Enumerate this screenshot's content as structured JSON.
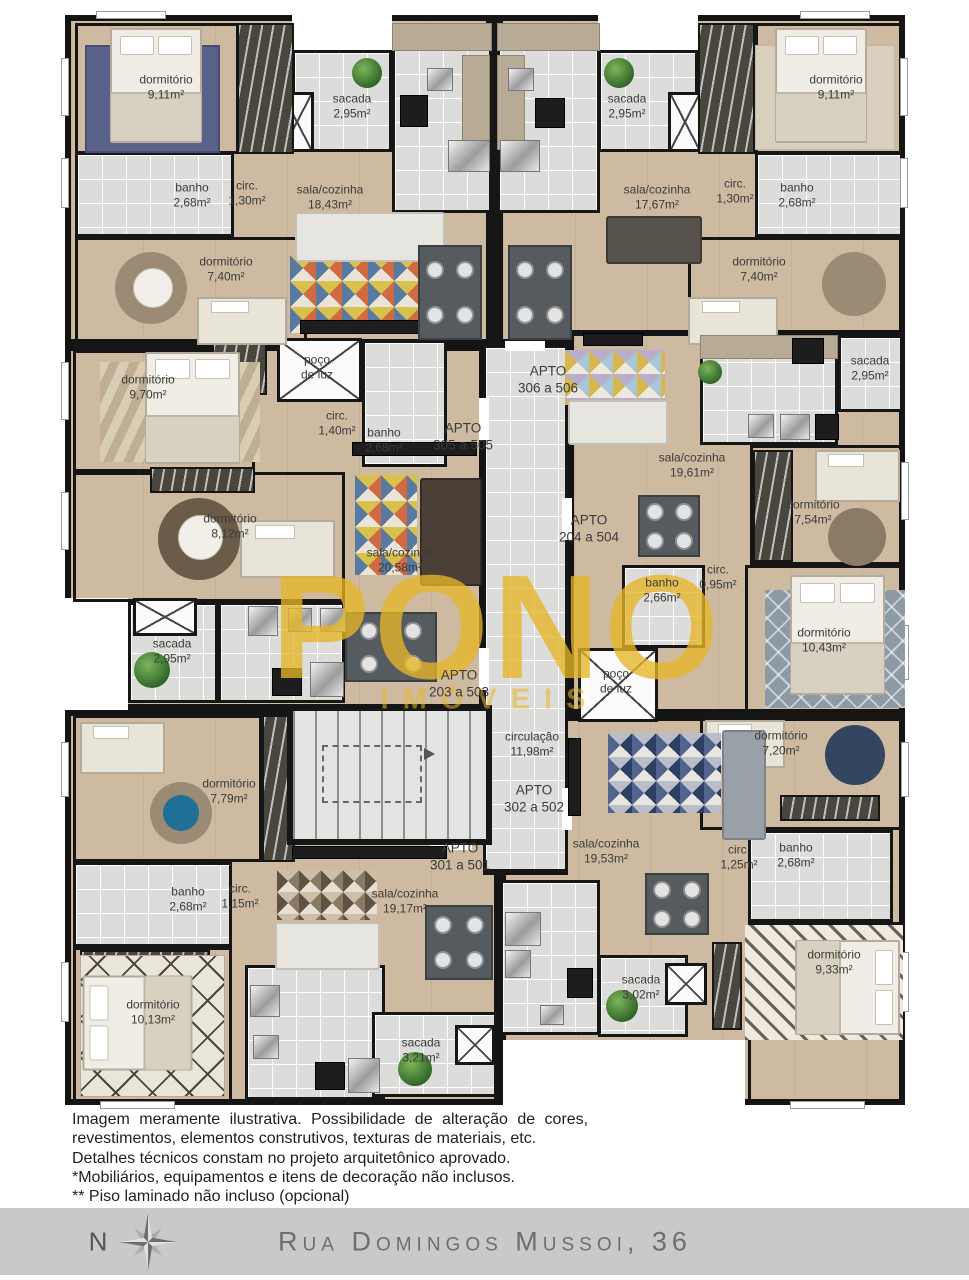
{
  "plan": {
    "apartments": [
      {
        "name": "APTO",
        "range": "305 a 505",
        "rooms": [
          {
            "name": "dormitório",
            "area": "9,11m²"
          },
          {
            "name": "sacada",
            "area": "2,95m²"
          },
          {
            "name": "banho",
            "area": "2,68m²"
          },
          {
            "name": "circ.",
            "area": "1,30m²"
          },
          {
            "name": "sala/cozinha",
            "area": "18,43m²"
          },
          {
            "name": "dormitório",
            "area": "7,40m²"
          }
        ]
      },
      {
        "name": "APTO",
        "range": "306 a 506",
        "rooms": [
          {
            "name": "sacada",
            "area": "2,95m²"
          },
          {
            "name": "dormitório",
            "area": "9,11m²"
          },
          {
            "name": "sala/cozinha",
            "area": "17,67m²"
          },
          {
            "name": "circ.",
            "area": "1,30m²"
          },
          {
            "name": "banho",
            "area": "2,68m²"
          },
          {
            "name": "dormitório",
            "area": "7,40m²"
          }
        ]
      },
      {
        "name": "APTO",
        "range": "203 a 503",
        "rooms": [
          {
            "name": "dormitório",
            "area": "9,70m²"
          },
          {
            "name": "circ.",
            "area": "1,40m²"
          },
          {
            "name": "banho",
            "area": "2,68m²"
          },
          {
            "name": "dormitório",
            "area": "8,12m²"
          },
          {
            "name": "sala/cozinha",
            "area": "20,58m²"
          },
          {
            "name": "sacada",
            "area": "2,95m²"
          }
        ]
      },
      {
        "name": "APTO",
        "range": "204 a 504",
        "rooms": [
          {
            "name": "sala/cozinha",
            "area": "19,61m²"
          },
          {
            "name": "sacada",
            "area": "2,95m²"
          },
          {
            "name": "dormitório",
            "area": "7,54m²"
          },
          {
            "name": "banho",
            "area": "2,66m²"
          },
          {
            "name": "circ.",
            "area": "0,95m²"
          },
          {
            "name": "dormitório",
            "area": "10,43m²"
          }
        ]
      },
      {
        "name": "APTO",
        "range": "301 a 501",
        "rooms": [
          {
            "name": "dormitório",
            "area": "7,79m²"
          },
          {
            "name": "banho",
            "area": "2,68m²"
          },
          {
            "name": "circ.",
            "area": "1,15m²"
          },
          {
            "name": "sala/cozinha",
            "area": "19,17m²"
          },
          {
            "name": "dormitório",
            "area": "10,13m²"
          },
          {
            "name": "sacada",
            "area": "3,21m²"
          }
        ]
      },
      {
        "name": "APTO",
        "range": "302 a 502",
        "rooms": [
          {
            "name": "sala/cozinha",
            "area": "19,53m²"
          },
          {
            "name": "dormitório",
            "area": "7,20m²"
          },
          {
            "name": "circ.",
            "area": "1,25m²"
          },
          {
            "name": "banho",
            "area": "2,68m²"
          },
          {
            "name": "dormitório",
            "area": "9,33m²"
          },
          {
            "name": "sacada",
            "area": "3,02m²"
          }
        ]
      }
    ],
    "common": {
      "circulacao": {
        "name": "circulação",
        "area": "11,98m²"
      },
      "poco_de_luz_1": {
        "line1": "poço",
        "line2": "de luz"
      },
      "poco_de_luz_2": {
        "line1": "poço",
        "line2": "de luz"
      }
    },
    "watermark": {
      "line1": "PONO",
      "line2": "IMÓVEIS"
    }
  },
  "disclaimer": {
    "line1": "Imagem meramente ilustrativa. Possibilidade de alteração de cores,",
    "line2": "revestimentos, elementos construtivos, texturas de materiais, etc.",
    "line3": "Detalhes técnicos constam no projeto arquitetônico aprovado.",
    "line4": "*Mobiliários, equipamentos e itens de decoração não inclusos.",
    "line5": "** Piso laminado não incluso (opcional)"
  },
  "footer": {
    "compass": "N",
    "address": "Rua Domingos Mussoi, 36"
  },
  "colors": {
    "floor": "#cdbaa1",
    "tile": "#dcdcda",
    "wall": "#161616",
    "watermark": "#e5b628",
    "footer_bar": "#c9c9c9"
  }
}
